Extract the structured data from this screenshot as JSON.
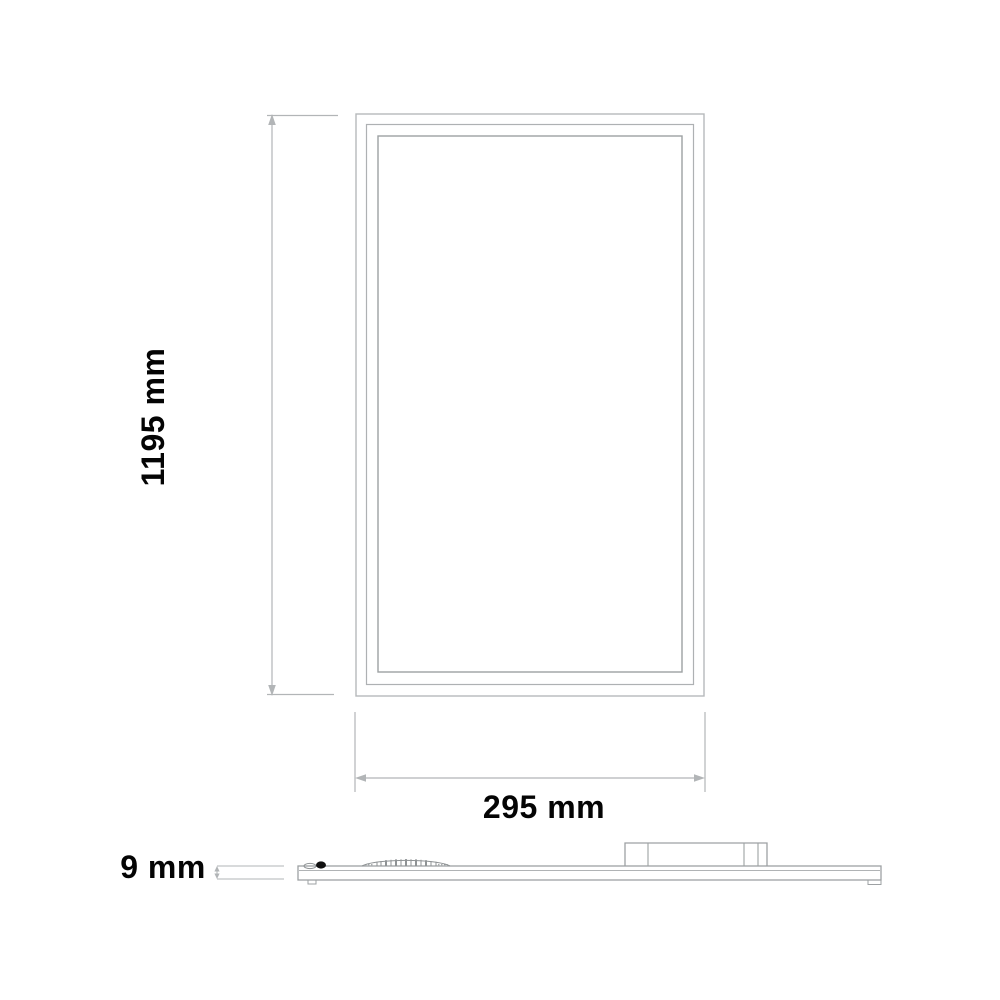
{
  "diagram": {
    "type": "technical-dimension-drawing",
    "front_view": {
      "height_label": "1195 mm",
      "width_label": "295 mm"
    },
    "side_view": {
      "thickness_label": "9 mm"
    },
    "colors": {
      "dimension_line_gray": "#b2b5b7",
      "outline_gray": "#a3a7a9",
      "label_black": "#040404",
      "background": "#ffffff"
    }
  }
}
